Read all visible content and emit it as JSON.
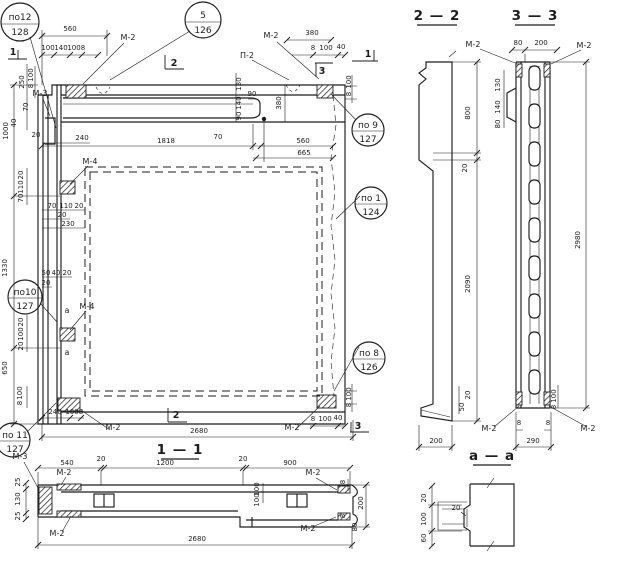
{
  "meta": {
    "kind": "structural panel working drawing",
    "language": "ru"
  },
  "colors": {
    "ink": "#1c1c1c",
    "paper": "#ffffff"
  },
  "section_headers": [
    {
      "label": "2 — 2"
    },
    {
      "label": "3 — 3"
    },
    {
      "label": "1 — 1"
    },
    {
      "label": "а — а"
    }
  ],
  "callouts": [
    {
      "top": "по12",
      "bottom": "128"
    },
    {
      "top": "5",
      "bottom": "126"
    },
    {
      "top": "по 9",
      "bottom": "127"
    },
    {
      "top": "по 1",
      "bottom": "124"
    },
    {
      "top": "по 8",
      "bottom": "126"
    },
    {
      "top": "по10",
      "bottom": "127"
    },
    {
      "top": "по 11",
      "bottom": "127"
    }
  ],
  "labels": [
    {
      "t": "560",
      "x": 70,
      "y": 31
    },
    {
      "t": "100",
      "x": 48,
      "y": 50
    },
    {
      "t": "140",
      "x": 61,
      "y": 50
    },
    {
      "t": "100",
      "x": 74,
      "y": 50
    },
    {
      "t": "8",
      "x": 83,
      "y": 50
    },
    {
      "t": "М-2",
      "x": 128,
      "y": 40,
      "cls": "lbl"
    },
    {
      "t": "380",
      "x": 312,
      "y": 35
    },
    {
      "t": "8",
      "x": 313,
      "y": 50
    },
    {
      "t": "100",
      "x": 326,
      "y": 50
    },
    {
      "t": "40",
      "x": 341,
      "y": 49
    },
    {
      "t": "П-2",
      "x": 247,
      "y": 58,
      "cls": "lbl"
    },
    {
      "t": "М-2",
      "x": 271,
      "y": 38,
      "cls": "lbl"
    },
    {
      "t": "1",
      "x": 13,
      "y": 55,
      "cls": "mk"
    },
    {
      "t": "1",
      "x": 368,
      "y": 57,
      "cls": "mk"
    },
    {
      "t": "2",
      "x": 174,
      "y": 66,
      "cls": "mk"
    },
    {
      "t": "3",
      "x": 322,
      "y": 74,
      "cls": "mk"
    },
    {
      "t": "100",
      "x": 351,
      "y": 82,
      "r": 1
    },
    {
      "t": "8",
      "x": 351,
      "y": 94,
      "r": 1
    },
    {
      "t": "130",
      "x": 241,
      "y": 84,
      "r": 1
    },
    {
      "t": "140",
      "x": 241,
      "y": 103,
      "r": 1
    },
    {
      "t": "90",
      "x": 241,
      "y": 116,
      "r": 1
    },
    {
      "t": "90",
      "x": 252,
      "y": 96
    },
    {
      "t": "380",
      "x": 281,
      "y": 103,
      "r": 1
    },
    {
      "t": "1818",
      "x": 166,
      "y": 143
    },
    {
      "t": "70",
      "x": 218,
      "y": 139
    },
    {
      "t": "560",
      "x": 303,
      "y": 143
    },
    {
      "t": "665",
      "x": 304,
      "y": 155
    },
    {
      "t": "250",
      "x": 24,
      "y": 82,
      "r": 1
    },
    {
      "t": "100",
      "x": 33,
      "y": 75,
      "r": 1
    },
    {
      "t": "8",
      "x": 33,
      "y": 86,
      "r": 1
    },
    {
      "t": "М-3",
      "x": 40,
      "y": 96,
      "cls": "lbl"
    },
    {
      "t": "70",
      "x": 28,
      "y": 107,
      "r": 1
    },
    {
      "t": "40",
      "x": 16,
      "y": 123,
      "r": 1
    },
    {
      "t": "1000",
      "x": 8,
      "y": 131,
      "r": 1
    },
    {
      "t": "20",
      "x": 36,
      "y": 137
    },
    {
      "t": "240",
      "x": 82,
      "y": 140
    },
    {
      "t": "20",
      "x": 23,
      "y": 175,
      "r": 1
    },
    {
      "t": "110",
      "x": 23,
      "y": 187,
      "r": 1
    },
    {
      "t": "70",
      "x": 23,
      "y": 198,
      "r": 1
    },
    {
      "t": "М-4",
      "x": 90,
      "y": 164,
      "cls": "lbl"
    },
    {
      "t": "70",
      "x": 52,
      "y": 208
    },
    {
      "t": "110",
      "x": 66,
      "y": 208
    },
    {
      "t": "20",
      "x": 79,
      "y": 208
    },
    {
      "t": "20",
      "x": 62,
      "y": 217
    },
    {
      "t": "230",
      "x": 68,
      "y": 226
    },
    {
      "t": "1330",
      "x": 7,
      "y": 268,
      "r": 1
    },
    {
      "t": "50",
      "x": 46,
      "y": 275
    },
    {
      "t": "40",
      "x": 56,
      "y": 275
    },
    {
      "t": "20",
      "x": 67,
      "y": 275
    },
    {
      "t": "20",
      "x": 46,
      "y": 285
    },
    {
      "t": "М-4",
      "x": 87,
      "y": 309,
      "cls": "lbl"
    },
    {
      "t": "20",
      "x": 23,
      "y": 322,
      "r": 1
    },
    {
      "t": "100",
      "x": 23,
      "y": 334,
      "r": 1
    },
    {
      "t": "20",
      "x": 23,
      "y": 346,
      "r": 1
    },
    {
      "t": "а",
      "x": 67,
      "y": 313,
      "cls": "lbl"
    },
    {
      "t": "а",
      "x": 67,
      "y": 355,
      "cls": "lbl"
    },
    {
      "t": "650",
      "x": 7,
      "y": 368,
      "r": 1
    },
    {
      "t": "100",
      "x": 22,
      "y": 393,
      "r": 1
    },
    {
      "t": "8",
      "x": 22,
      "y": 403,
      "r": 1
    },
    {
      "t": "240",
      "x": 55,
      "y": 414
    },
    {
      "t": "100",
      "x": 72,
      "y": 414
    },
    {
      "t": "8",
      "x": 81,
      "y": 414
    },
    {
      "t": "М-2",
      "x": 113,
      "y": 430,
      "cls": "lbl"
    },
    {
      "t": "2",
      "x": 176,
      "y": 418,
      "cls": "mk"
    },
    {
      "t": "2680",
      "x": 199,
      "y": 433
    },
    {
      "t": "М-2",
      "x": 292,
      "y": 430,
      "cls": "lbl"
    },
    {
      "t": "8",
      "x": 313,
      "y": 421
    },
    {
      "t": "100",
      "x": 325,
      "y": 421
    },
    {
      "t": "40",
      "x": 338,
      "y": 420
    },
    {
      "t": "3",
      "x": 358,
      "y": 429,
      "cls": "mk"
    },
    {
      "t": "100",
      "x": 351,
      "y": 394,
      "r": 1
    },
    {
      "t": "8",
      "x": 351,
      "y": 405,
      "r": 1
    },
    {
      "t": "540",
      "x": 67,
      "y": 465
    },
    {
      "t": "20",
      "x": 101,
      "y": 461
    },
    {
      "t": "1200",
      "x": 165,
      "y": 465
    },
    {
      "t": "20",
      "x": 243,
      "y": 461
    },
    {
      "t": "900",
      "x": 290,
      "y": 465
    },
    {
      "t": "М-2",
      "x": 64,
      "y": 475,
      "cls": "lbl"
    },
    {
      "t": "М-2",
      "x": 57,
      "y": 536,
      "cls": "lbl"
    },
    {
      "t": "М-2",
      "x": 313,
      "y": 475,
      "cls": "lbl"
    },
    {
      "t": "М-2",
      "x": 308,
      "y": 531,
      "cls": "lbl"
    },
    {
      "t": "25",
      "x": 20,
      "y": 482,
      "r": 1
    },
    {
      "t": "130",
      "x": 20,
      "y": 499,
      "r": 1
    },
    {
      "t": "25",
      "x": 20,
      "y": 516,
      "r": 1
    },
    {
      "t": "100",
      "x": 259,
      "y": 489,
      "r": 1
    },
    {
      "t": "100",
      "x": 259,
      "y": 500,
      "r": 1
    },
    {
      "t": "8",
      "x": 345,
      "y": 482,
      "r": 1
    },
    {
      "t": "200",
      "x": 363,
      "y": 503,
      "r": 1
    },
    {
      "t": "8",
      "x": 345,
      "y": 516,
      "r": 1
    },
    {
      "t": "80",
      "x": 357,
      "y": 527,
      "r": 1
    },
    {
      "t": "2680",
      "x": 197,
      "y": 541
    },
    {
      "t": "М-3",
      "x": 20,
      "y": 459,
      "cls": "lbl"
    },
    {
      "t": "800",
      "x": 470,
      "y": 113,
      "r": 1
    },
    {
      "t": "20",
      "x": 467,
      "y": 168,
      "r": 1
    },
    {
      "t": "2090",
      "x": 470,
      "y": 284,
      "r": 1
    },
    {
      "t": "20",
      "x": 470,
      "y": 395,
      "r": 1
    },
    {
      "t": "50",
      "x": 464,
      "y": 407,
      "r": 1
    },
    {
      "t": "200",
      "x": 436,
      "y": 443
    },
    {
      "t": "80",
      "x": 518,
      "y": 45
    },
    {
      "t": "200",
      "x": 541,
      "y": 45
    },
    {
      "t": "130",
      "x": 500,
      "y": 85,
      "r": 1
    },
    {
      "t": "140",
      "x": 500,
      "y": 107,
      "r": 1
    },
    {
      "t": "80",
      "x": 500,
      "y": 124,
      "r": 1
    },
    {
      "t": "2980",
      "x": 580,
      "y": 240,
      "r": 1
    },
    {
      "t": "100",
      "x": 556,
      "y": 396,
      "r": 1
    },
    {
      "t": "8",
      "x": 556,
      "y": 407,
      "r": 1
    },
    {
      "t": "8",
      "x": 519,
      "y": 425
    },
    {
      "t": "8",
      "x": 548,
      "y": 425
    },
    {
      "t": "290",
      "x": 533,
      "y": 443
    },
    {
      "t": "М-2",
      "x": 473,
      "y": 47,
      "cls": "lbl"
    },
    {
      "t": "М-2",
      "x": 584,
      "y": 48,
      "cls": "lbl"
    },
    {
      "t": "М-2",
      "x": 489,
      "y": 431,
      "cls": "lbl"
    },
    {
      "t": "М-2",
      "x": 588,
      "y": 431,
      "cls": "lbl"
    },
    {
      "t": "20",
      "x": 426,
      "y": 498,
      "r": 1
    },
    {
      "t": "100",
      "x": 426,
      "y": 519,
      "r": 1
    },
    {
      "t": "60",
      "x": 426,
      "y": 538,
      "r": 1
    },
    {
      "t": "20",
      "x": 456,
      "y": 510
    }
  ]
}
